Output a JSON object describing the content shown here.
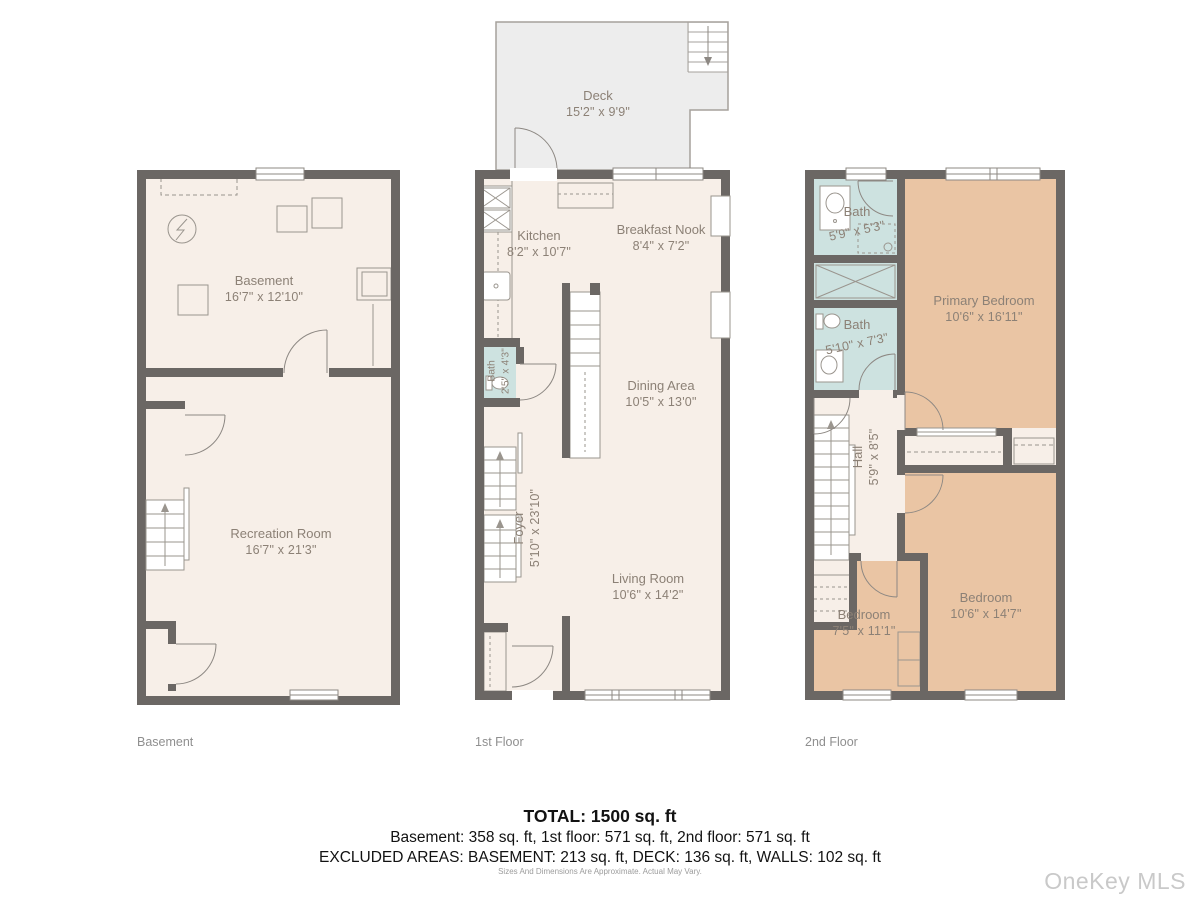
{
  "watermark": "OneKey MLS",
  "disclaimer": "Sizes And Dimensions Are Approximate. Actual May Vary.",
  "summary": {
    "total": "TOTAL: 1500 sq. ft",
    "by_floor": "Basement: 358 sq. ft, 1st floor: 571 sq. ft, 2nd floor: 571 sq. ft",
    "excluded": "EXCLUDED AREAS: BASEMENT: 213 sq. ft, DECK: 136 sq. ft, WALLS: 102 sq. ft"
  },
  "colors": {
    "wall": "#6b6764",
    "floor": "#f7efe8",
    "bath": "#cde2e0",
    "bedroom": "#eac5a4",
    "deck": "#ededed",
    "label_text": "#8c8176"
  },
  "floors": {
    "basement": {
      "caption": "Basement",
      "rooms": {
        "basement": {
          "name": "Basement",
          "dims": "16'7\" x 12'10\""
        },
        "recreation": {
          "name": "Recreation Room",
          "dims": "16'7\" x 21'3\""
        }
      }
    },
    "first": {
      "caption": "1st Floor",
      "rooms": {
        "deck": {
          "name": "Deck",
          "dims": "15'2\" x 9'9\""
        },
        "kitchen": {
          "name": "Kitchen",
          "dims": "8'2\" x 10'7\""
        },
        "breakfast_nook": {
          "name": "Breakfast Nook",
          "dims": "8'4\" x 7'2\""
        },
        "dining": {
          "name": "Dining Area",
          "dims": "10'5\" x 13'0\""
        },
        "bath": {
          "name": "Bath",
          "dims": "2'5\" x 4'3\""
        },
        "foyer": {
          "name": "Foyer",
          "dims": "5'10\" x 23'10\""
        },
        "living": {
          "name": "Living Room",
          "dims": "10'6\" x 14'2\""
        }
      }
    },
    "second": {
      "caption": "2nd Floor",
      "rooms": {
        "bath_upper": {
          "name": "Bath",
          "dims": "5'9\" x 5'3\""
        },
        "bath_lower": {
          "name": "Bath",
          "dims": "5'10\" x 7'3\""
        },
        "primary": {
          "name": "Primary Bedroom",
          "dims": "10'6\" x 16'11\""
        },
        "hall": {
          "name": "Hall",
          "dims": "5'9\" x 8'5\""
        },
        "bedroom_small": {
          "name": "Bedroom",
          "dims": "7'5\" x 11'1\""
        },
        "bedroom_large": {
          "name": "Bedroom",
          "dims": "10'6\" x 14'7\""
        }
      }
    }
  }
}
